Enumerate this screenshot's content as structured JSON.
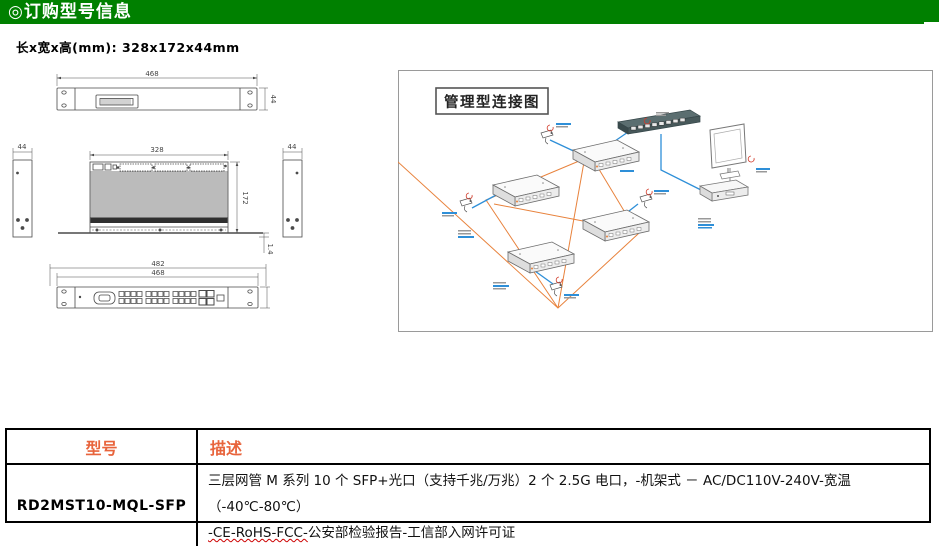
{
  "header_bars": {
    "dimensions_title": "◎产品外观尺寸",
    "application_title": "◎产品应用示意图",
    "ordering_title": "◎订购型号信息"
  },
  "dimensions": {
    "size_label": "长x宽x高(mm): 328x172x44mm",
    "front_view": {
      "width": "468",
      "height": "44"
    },
    "top_view": {
      "width": "328",
      "depth": "172",
      "ear_thickness": "1.4"
    },
    "side_views": {
      "left_width": "44",
      "right_width": "44"
    },
    "rear_view": {
      "outer_width": "482",
      "inner_width": "468"
    }
  },
  "application": {
    "diagram_title": "管理型连接图"
  },
  "ordering_table": {
    "headers": [
      "型号",
      "描述"
    ],
    "rows": [
      {
        "model": "RD2MST10-MQL-SFP",
        "description_line1": "三层网管 M 系列 10 个 SFP+光口（支持千兆/万兆）2 个 2.5G 电口，-机架式 － AC/DC110V-240V-宽温（-40℃-80℃）",
        "description_line2_marked": "-CE-RoHS-FCC-",
        "description_line2_rest": "公安部检验报告-工信部入网许可证"
      }
    ]
  },
  "colors": {
    "section_header_bg": "#008000",
    "section_header_text": "#FFFFFF",
    "table_header_text": "#E8643C",
    "fiber_ring_line": "#E8823C",
    "ethernet_link_line": "#2E8FD8",
    "drawing_line": "#4A4A4A"
  }
}
